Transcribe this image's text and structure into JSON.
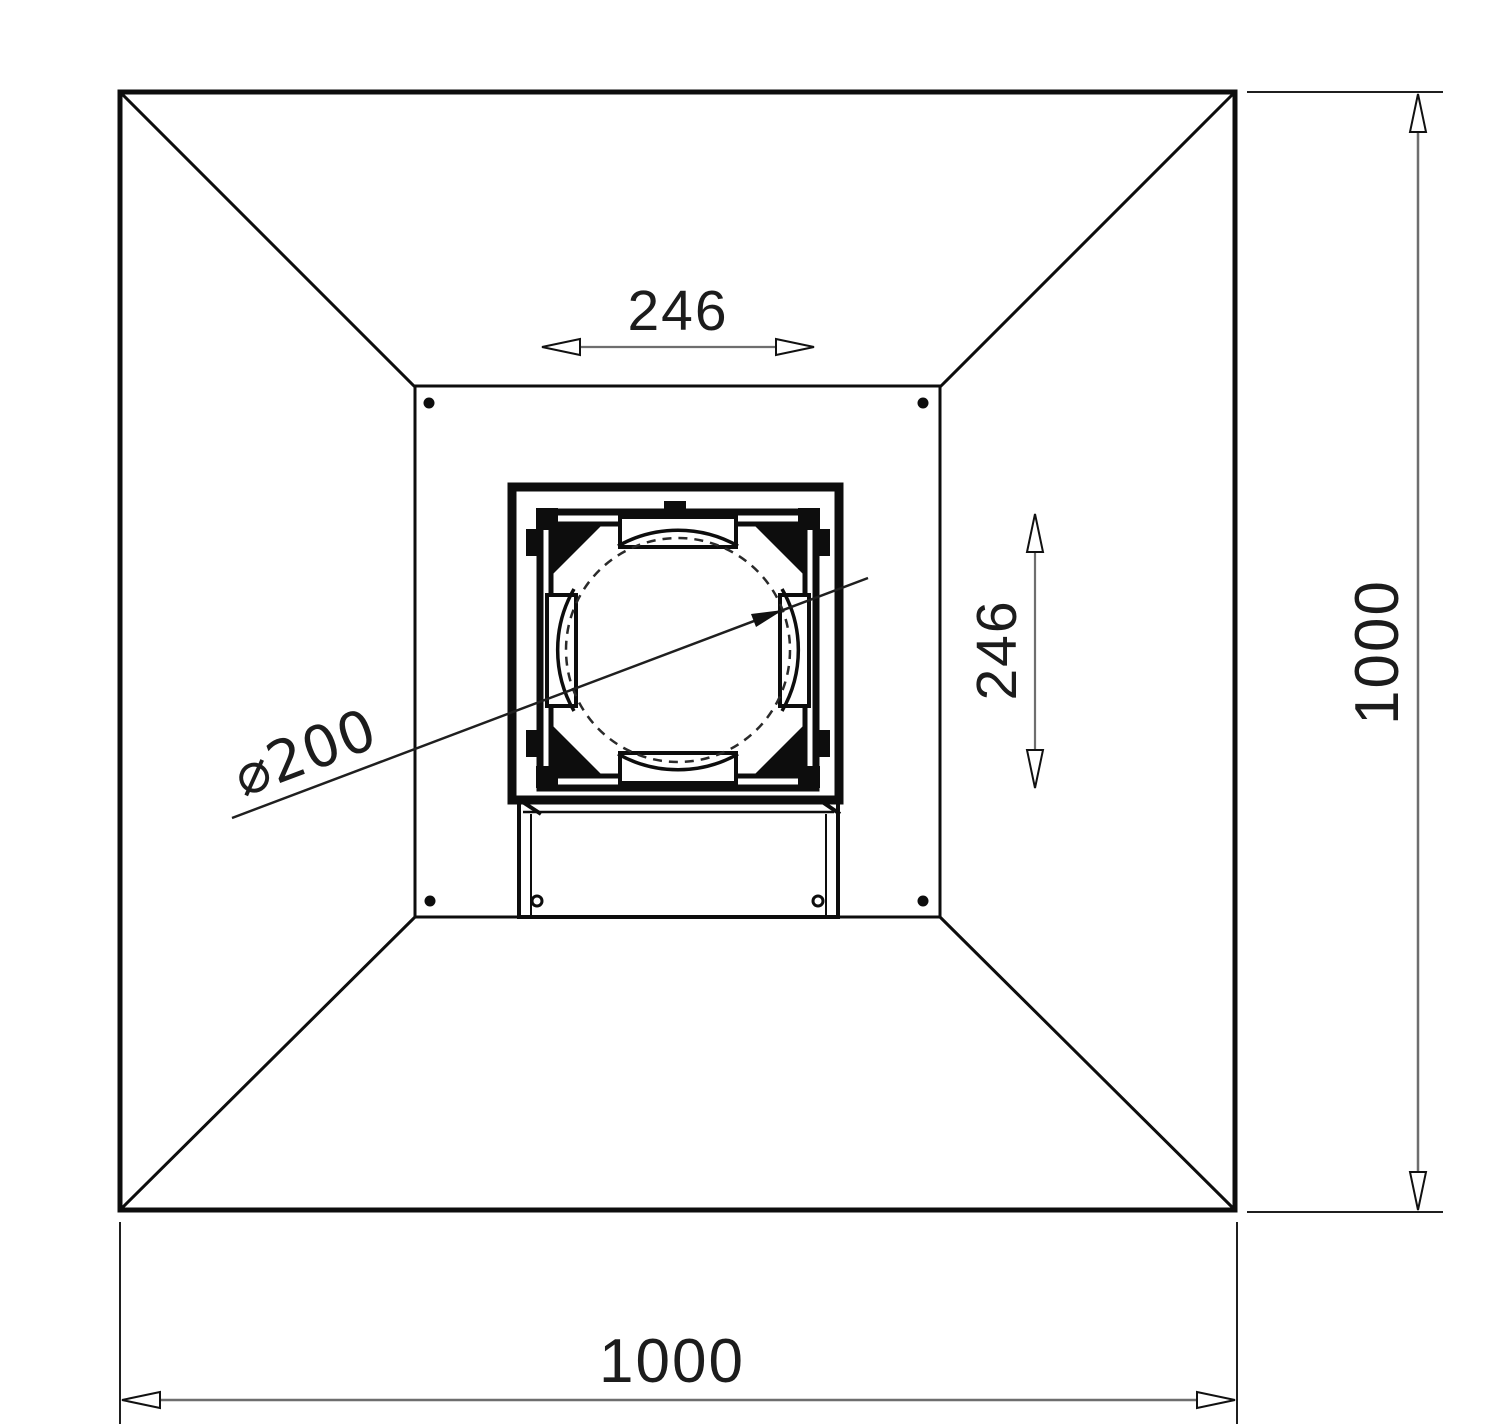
{
  "drawing": {
    "type": "technical-plan-view",
    "line_color": "#0d0d0d",
    "dim_line_color": "#6e6e6e",
    "background": "#ffffff",
    "labels": {
      "spigot_width": "246",
      "spigot_height": "246",
      "duct_diameter": "⌀200",
      "overall_width": "1000",
      "overall_height": "1000"
    }
  }
}
